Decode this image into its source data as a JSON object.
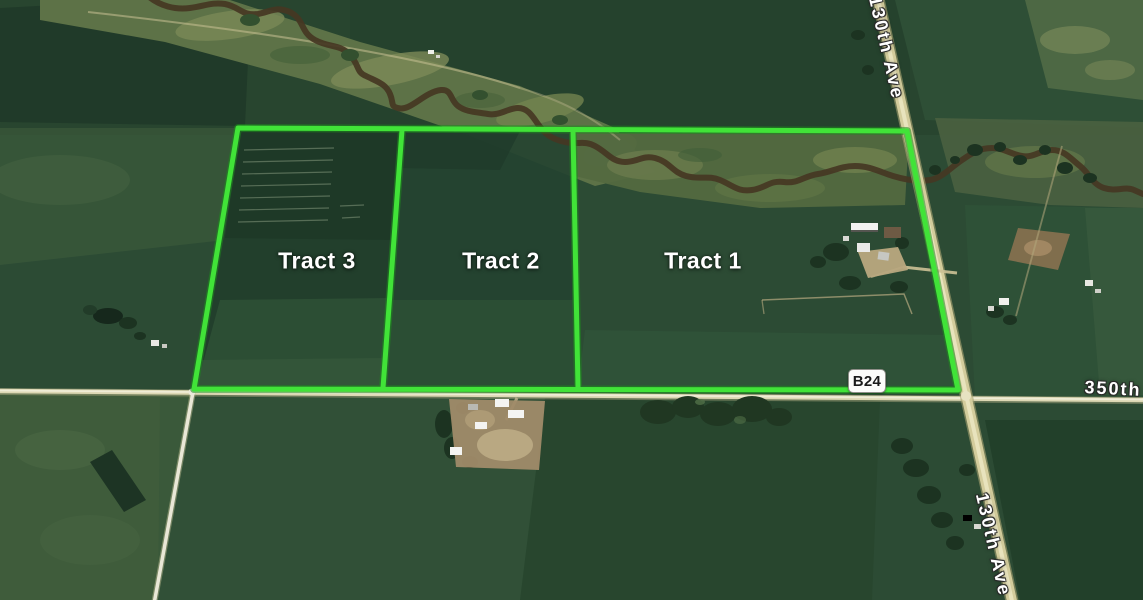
{
  "map": {
    "description": "Aerial satellite view of farmland with three auction tracts outlined in green",
    "tracts": [
      {
        "label": "Tract 1"
      },
      {
        "label": "Tract 2"
      },
      {
        "label": "Tract 3"
      }
    ],
    "roads": {
      "top_vertical_label": "130th Ave",
      "horizontal_label": "350th",
      "bottom_vertical_label": "130th Ave"
    },
    "route_badge": {
      "label": "B24"
    },
    "colors": {
      "tract_outline": "#41e338",
      "label_text": "#ffffff",
      "road_label_text": "#ffffff",
      "badge_background": "#fcfcfa",
      "badge_text": "#1a1a1a",
      "badge_border": "#8e8e88",
      "river_brown": "#453723",
      "road_tan": "#d3cc9c",
      "field_dark_green": "#24412c",
      "field_light_moss": "#5d7247"
    }
  }
}
